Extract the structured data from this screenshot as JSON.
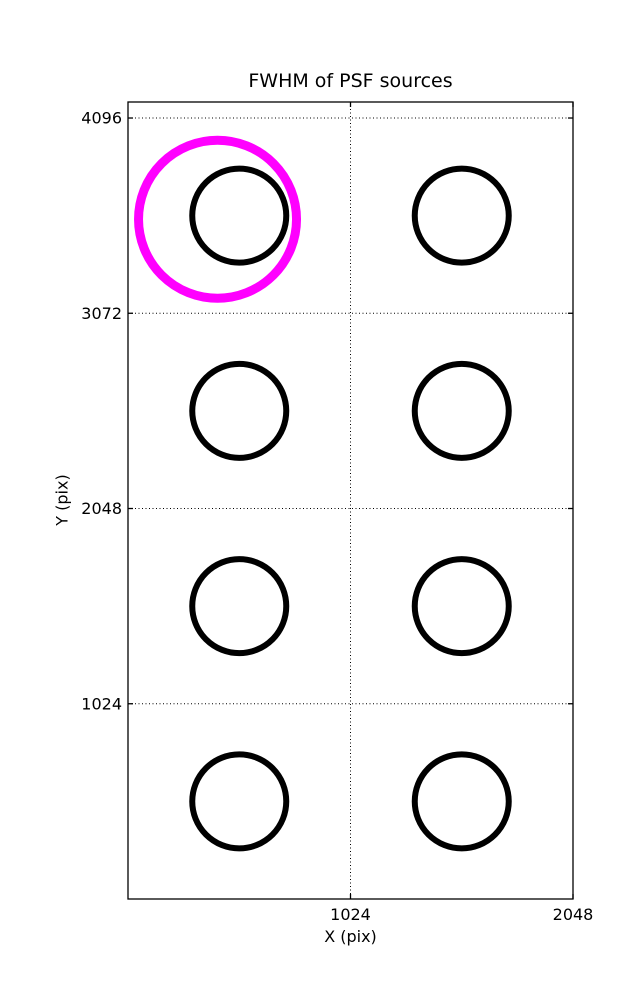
{
  "figure": {
    "background": "#ffffff"
  },
  "chart_data": {
    "type": "scatter",
    "title": "FWHM of PSF sources",
    "xlabel": "X (pix)",
    "ylabel": "Y (pix)",
    "xlim": [
      0,
      2048
    ],
    "ylim": [
      0,
      4180
    ],
    "xticks": [
      1024,
      2048
    ],
    "yticks": [
      1024,
      2048,
      3072,
      4096
    ],
    "grid": true,
    "grid_linestyle": "dotted",
    "legend": "none",
    "axes_color": "#000000",
    "series": [
      {
        "name": "PSF sources",
        "marker": "open-circle",
        "color": "#000000",
        "marker_radius_px": 47,
        "marker_stroke_px": 6,
        "points": [
          {
            "x": 512,
            "y": 3584
          },
          {
            "x": 1536,
            "y": 3584
          },
          {
            "x": 512,
            "y": 2560
          },
          {
            "x": 1536,
            "y": 2560
          },
          {
            "x": 512,
            "y": 1536
          },
          {
            "x": 1536,
            "y": 1536
          },
          {
            "x": 512,
            "y": 512
          },
          {
            "x": 1536,
            "y": 512
          }
        ]
      },
      {
        "name": "highlighted source",
        "marker": "open-circle",
        "color": "#ff00ff",
        "marker_radius_px": 79,
        "marker_stroke_px": 9,
        "points": [
          {
            "x": 412,
            "y": 3565
          }
        ]
      }
    ]
  }
}
